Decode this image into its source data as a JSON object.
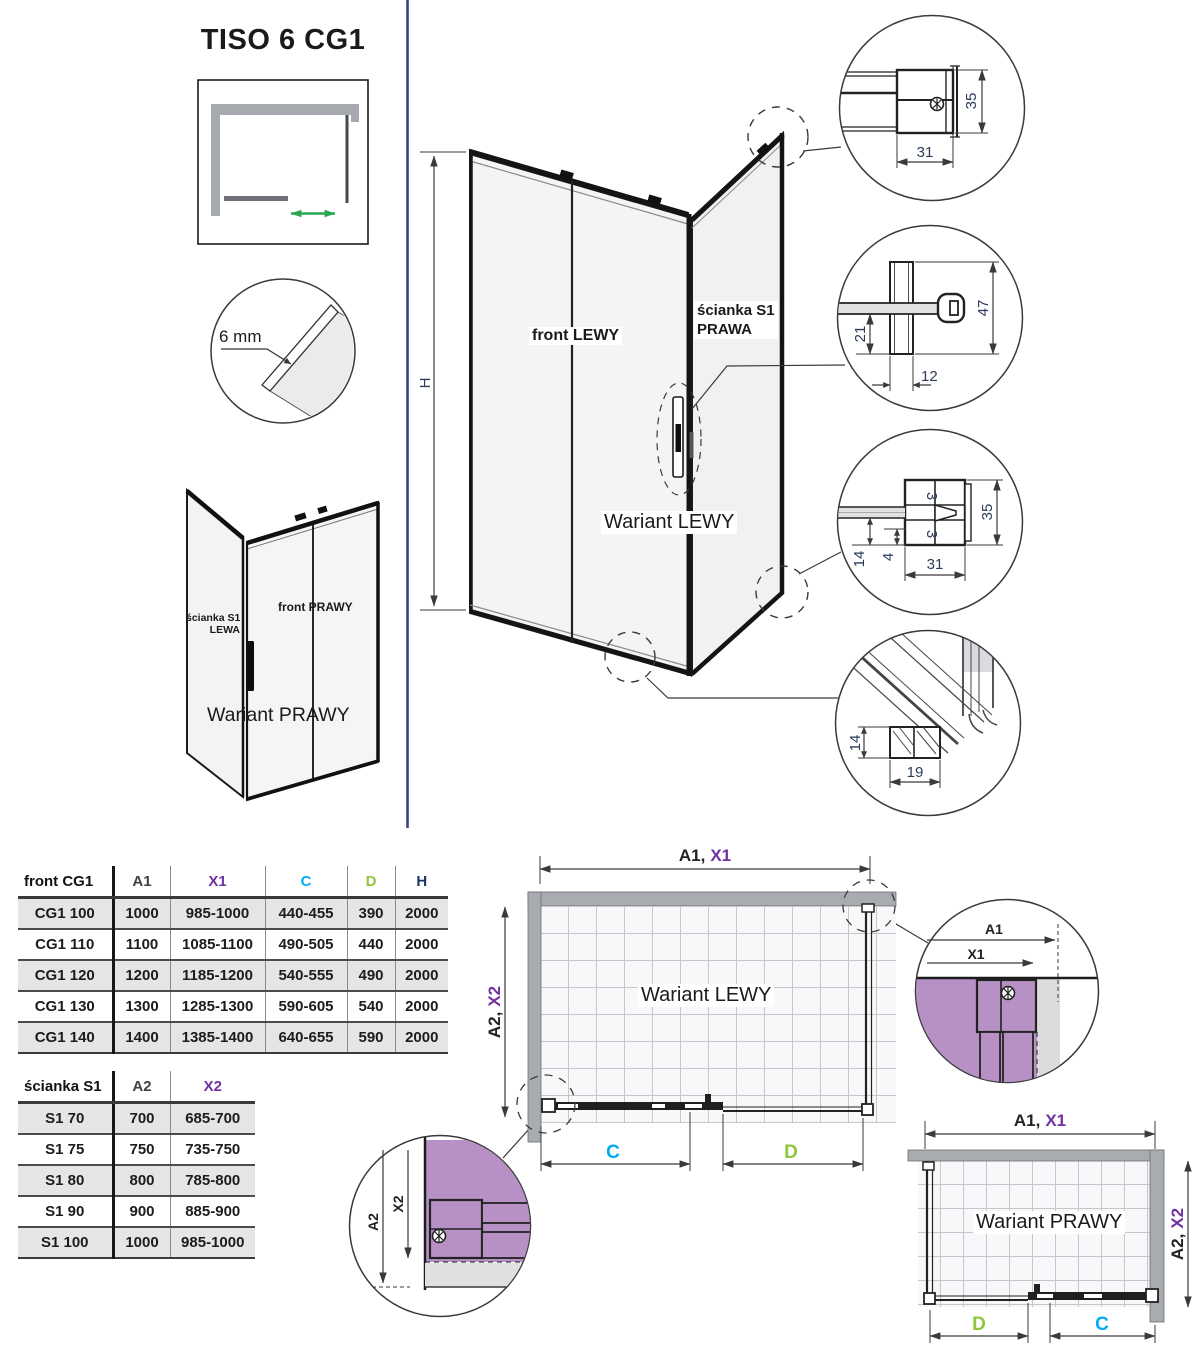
{
  "title": "TISO 6 CG1",
  "schematic": {
    "glass_thickness": "6 mm"
  },
  "iso_small": {
    "wall_label_1": "ścianka S1",
    "wall_label_2": "LEWA",
    "front_label": "front PRAWY",
    "caption": "Wariant PRAWY"
  },
  "iso_main": {
    "front_label": "front LEWY",
    "wall_label_1": "ścianka S1",
    "wall_label_2": "PRAWA",
    "caption": "Wariant LEWY",
    "height": "H"
  },
  "details": {
    "top_profile": {
      "height": "35",
      "width": "31"
    },
    "wall_profile": {
      "height": "47",
      "glass_offset": "21",
      "width": "12"
    },
    "bottom_profile": {
      "height": "35",
      "width": "31",
      "rail": "14",
      "gap": "4",
      "glass": "3"
    },
    "rail_profile": {
      "height": "14",
      "width": "19"
    }
  },
  "tables": {
    "front": {
      "header": [
        "front CG1",
        "A1",
        "X1",
        "C",
        "D",
        "H"
      ],
      "header_colors": [
        "#111111",
        "#404040",
        "#7030a0",
        "#00aeef",
        "#8ec63f",
        "#17365d"
      ],
      "rows": [
        [
          "CG1 100",
          "1000",
          "985-1000",
          "440-455",
          "390",
          "2000"
        ],
        [
          "CG1 110",
          "1100",
          "1085-1100",
          "490-505",
          "440",
          "2000"
        ],
        [
          "CG1 120",
          "1200",
          "1185-1200",
          "540-555",
          "490",
          "2000"
        ],
        [
          "CG1 130",
          "1300",
          "1285-1300",
          "590-605",
          "540",
          "2000"
        ],
        [
          "CG1 140",
          "1400",
          "1385-1400",
          "640-655",
          "590",
          "2000"
        ]
      ]
    },
    "wall": {
      "header": [
        "ścianka S1",
        "A2",
        "X2"
      ],
      "header_colors": [
        "#111111",
        "#404040",
        "#7030a0"
      ],
      "rows": [
        [
          "S1 70",
          "700",
          "685-700"
        ],
        [
          "S1 75",
          "750",
          "735-750"
        ],
        [
          "S1 80",
          "800",
          "785-800"
        ],
        [
          "S1 90",
          "900",
          "885-900"
        ],
        [
          "S1 100",
          "1000",
          "985-1000"
        ]
      ]
    }
  },
  "plans": {
    "left": {
      "caption": "Wariant LEWY",
      "a1": "A1,",
      "x1": "X1",
      "a2": "A2,",
      "x2": "X2",
      "c": "C",
      "d": "D"
    },
    "right": {
      "caption": "Wariant PRAWY",
      "a1": "A1,",
      "x1": "X1",
      "a2": "A2,",
      "x2": "X2",
      "c": "C",
      "d": "D"
    },
    "corner_detail_right": {
      "a1": "A1",
      "x1": "X1"
    },
    "corner_detail_left": {
      "a2": "A2",
      "x2": "X2"
    }
  },
  "colors": {
    "purple": "#7030a0",
    "cyan": "#00aeef",
    "green": "#8ec63f",
    "navy": "#17365d",
    "violet_fill": "#b791c5",
    "divider_blue": "#3a4284",
    "arrow_green": "#28a651"
  }
}
